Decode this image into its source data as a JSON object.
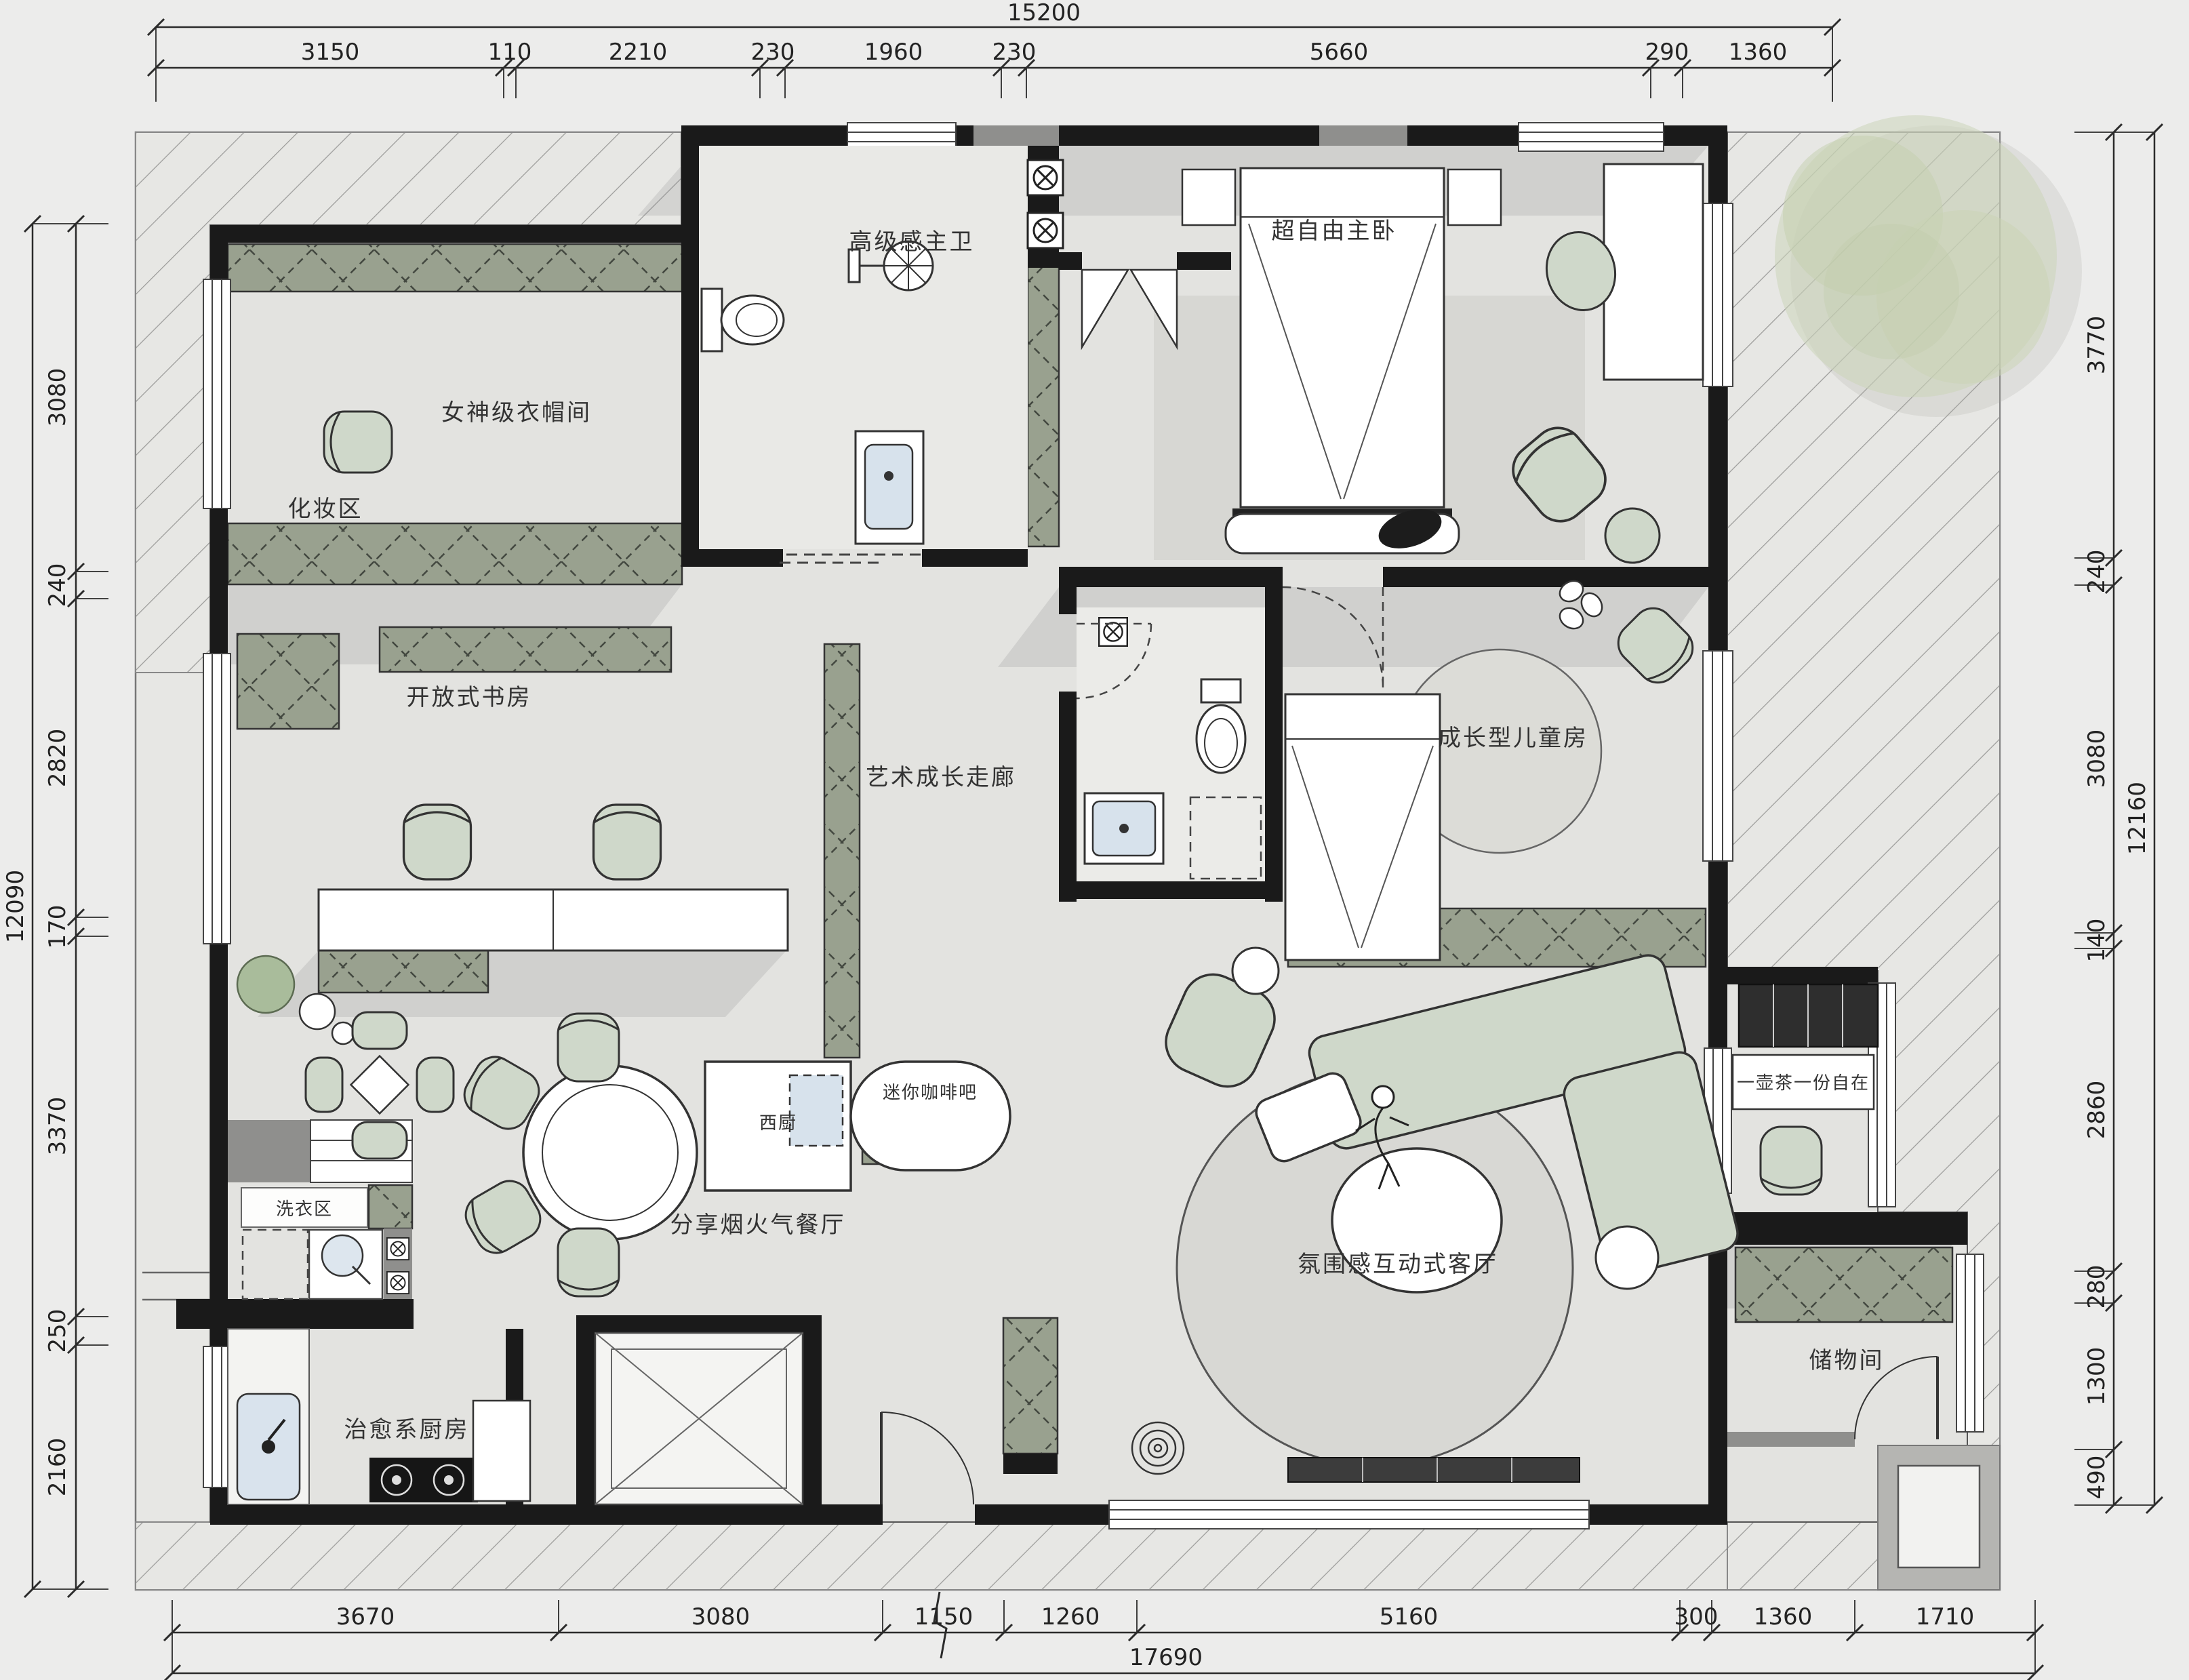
{
  "rooms": {
    "master_bath": "高级感主卫",
    "master_bedroom": "超自由主卧",
    "cloakroom": "女神级衣帽间",
    "makeup_area": "化妆区",
    "study": "开放式书房",
    "corridor": "艺术成长走廊",
    "kids_room": "成长型儿童房",
    "dining": "分享烟火气餐厅",
    "west_kitchen": "西厨",
    "coffee_bar": "迷你咖啡吧",
    "living_room": "氛围感互动式客厅",
    "tea_corner": "一壶茶一份自在",
    "laundry": "洗衣区",
    "kitchen": "治愈系厨房",
    "storage": "储物间"
  },
  "dims": {
    "top_total": "15200",
    "top": [
      "3150",
      "110",
      "2210",
      "230",
      "1960",
      "230",
      "5660",
      "290",
      "1360"
    ],
    "bottom_total": "17690",
    "bottom": [
      "3670",
      "3080",
      "1150",
      "1260",
      "5160",
      "300",
      "1360",
      "1710"
    ],
    "left_total": "12090",
    "left": [
      "3080",
      "240",
      "2820",
      "170",
      "3370",
      "250",
      "2160"
    ],
    "right_total": "12160",
    "right": [
      "3770",
      "240",
      "3080",
      "140",
      "2860",
      "280",
      "1300",
      "490"
    ]
  },
  "colors": {
    "wall": "#1a1a1a",
    "gray_wall": "#8f8f8d",
    "cabinet_green": "#99a18f",
    "furniture_green": "#cfd8ca",
    "accent_blue": "#d7e2ec",
    "floor": "#e3e3e0",
    "rug": "#d7d7d3",
    "tree_green": "#ccd5b9",
    "hatch_line": "#9c9c9a"
  }
}
